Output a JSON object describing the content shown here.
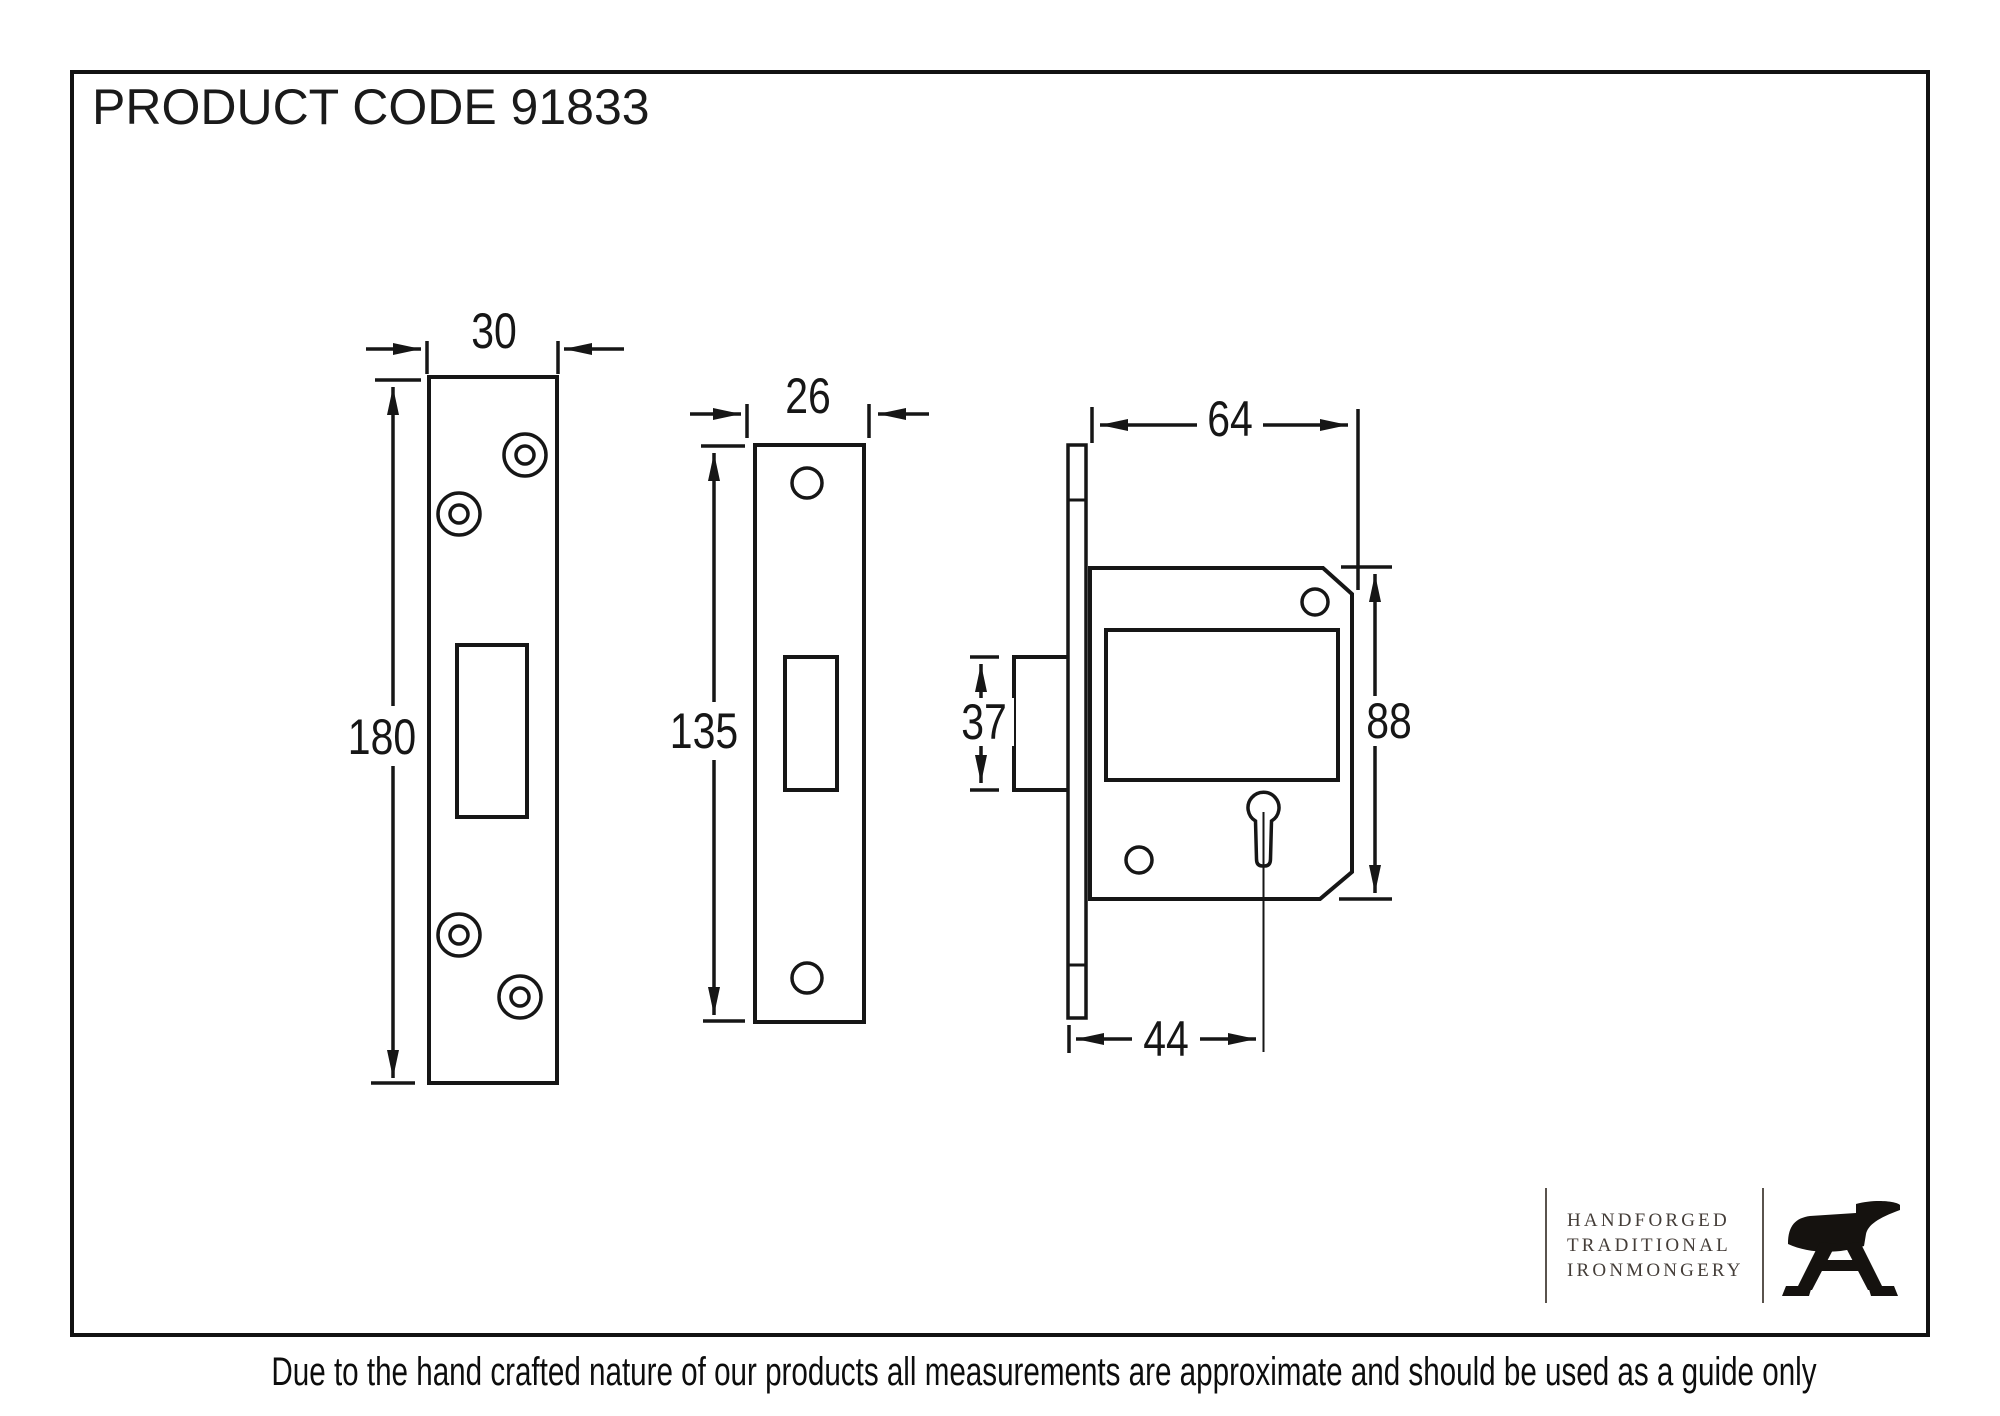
{
  "title": "PRODUCT CODE 91833",
  "drawing": {
    "keep_plate": {
      "width_mm": "30",
      "height_mm": "180"
    },
    "faceplate": {
      "width_mm": "26",
      "height_mm": "135"
    },
    "lock_case": {
      "depth_mm": "64",
      "height_mm": "88",
      "bolt_height_mm": "37",
      "backset_mm": "44"
    }
  },
  "logo": {
    "line1": "HANDFORGED",
    "line2": "TRADITIONAL",
    "line3": "IRONMONGERY",
    "icon": "anvil-icon"
  },
  "footer": {
    "disclaimer": "Due to the hand crafted nature of our products all measurements are approximate and should be used as a guide only"
  },
  "colors": {
    "line": "#161616",
    "background": "#ffffff"
  }
}
